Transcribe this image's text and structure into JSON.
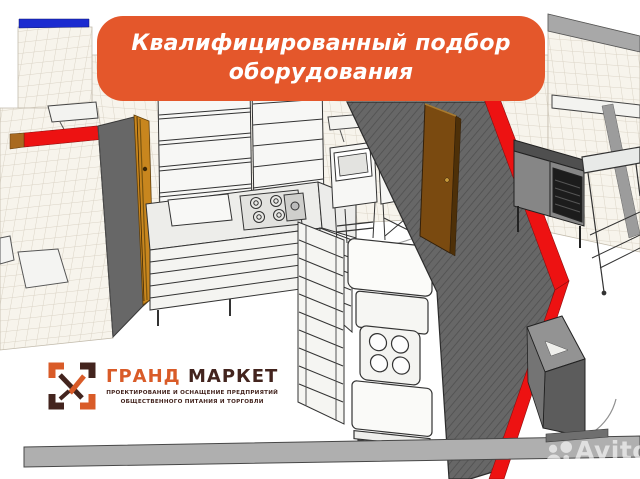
{
  "banner": {
    "line1": "Квалифицированный подбор",
    "line2": "оборудования"
  },
  "logo": {
    "icon": "grand-market-check-icon",
    "title_part1": "ГРАНД",
    "title_part2": "МАРКЕТ",
    "tagline_line1": "ПРОЕКТИРОВАНИЕ И ОСНАЩЕНИЕ ПРЕДПРИЯТИЙ",
    "tagline_line2": "ОБЩЕСТВЕННОГО ПИТАНИЯ И ТОРГОВЛИ"
  },
  "watermark": {
    "icon": "avito-circles-icon",
    "text": "Avito"
  },
  "colors": {
    "banner_orange": "#E4572B",
    "accent_red": "#ED1212",
    "blue_band": "#1B2BD0",
    "wall_gray": "#676767",
    "door_brown": "#7A4A10",
    "door_frame_orange": "#C8861E",
    "tile_bg": "#F7F4EC",
    "tile_line": "#DAD3C5",
    "bar_gray": "#AFAFAF",
    "logo_orange": "#D95B28",
    "logo_dark": "#43241E",
    "watermark_color": "rgba(255,255,255,0.62)"
  }
}
